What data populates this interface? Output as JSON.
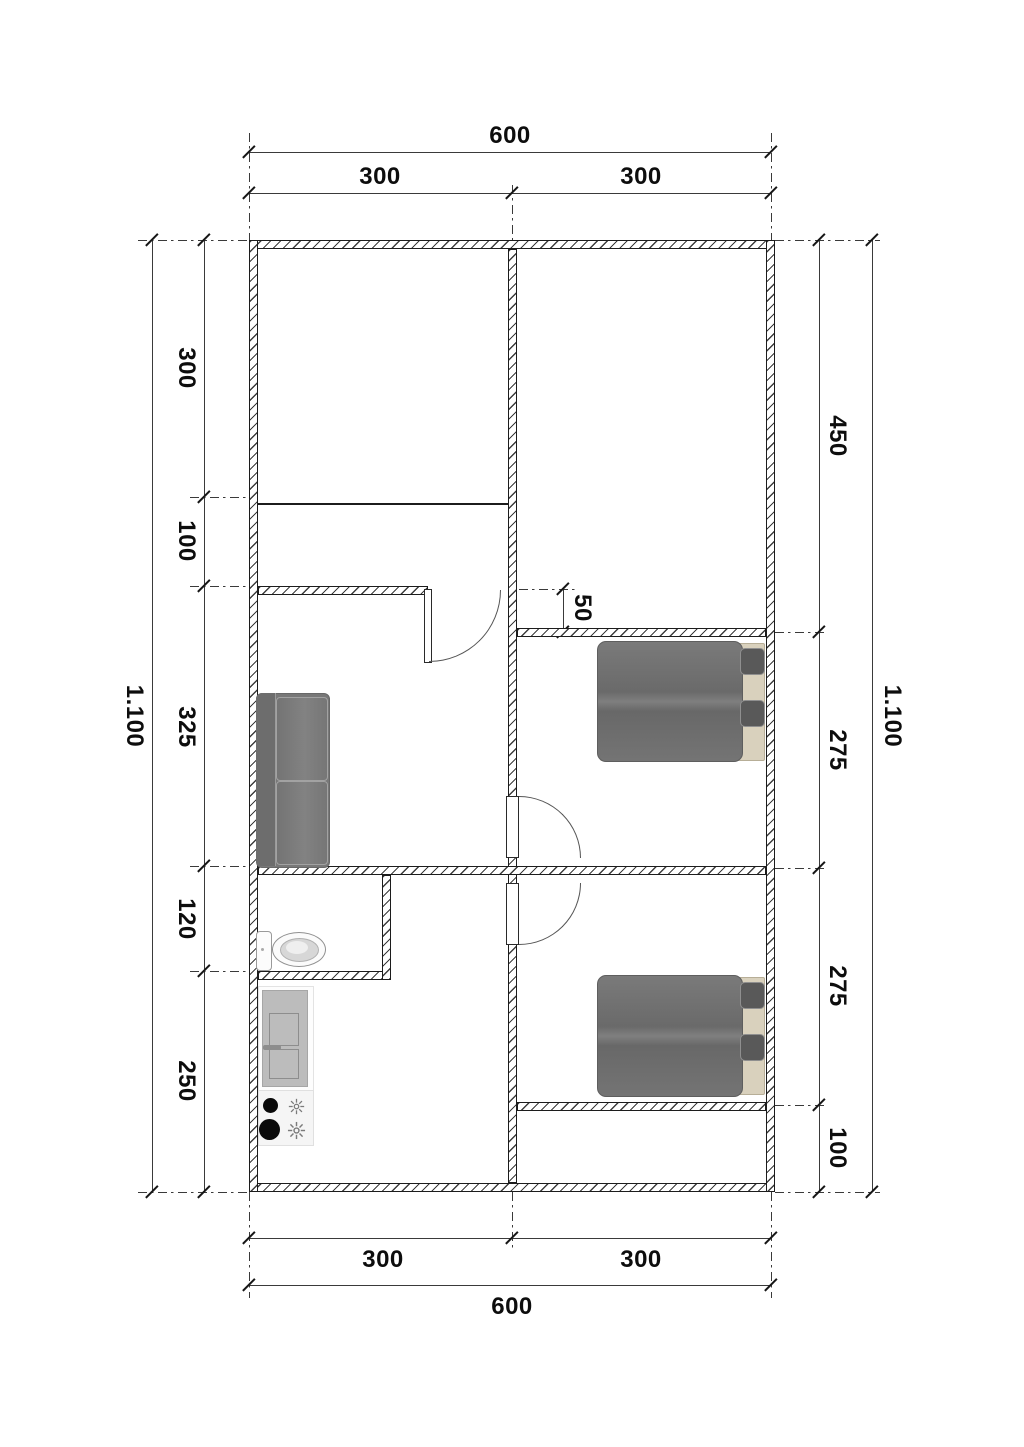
{
  "dims": {
    "top": {
      "overall": "600",
      "segments": [
        "300",
        "300"
      ]
    },
    "bottom": {
      "overall": "600",
      "segments": [
        "300",
        "300"
      ]
    },
    "left": {
      "overall": "1.100",
      "segments": [
        "300",
        "100",
        "325",
        "120",
        "250"
      ]
    },
    "right": {
      "overall": "1.100",
      "segments": [
        "450",
        "275",
        "275",
        "100"
      ]
    },
    "wall_offset": "50"
  }
}
